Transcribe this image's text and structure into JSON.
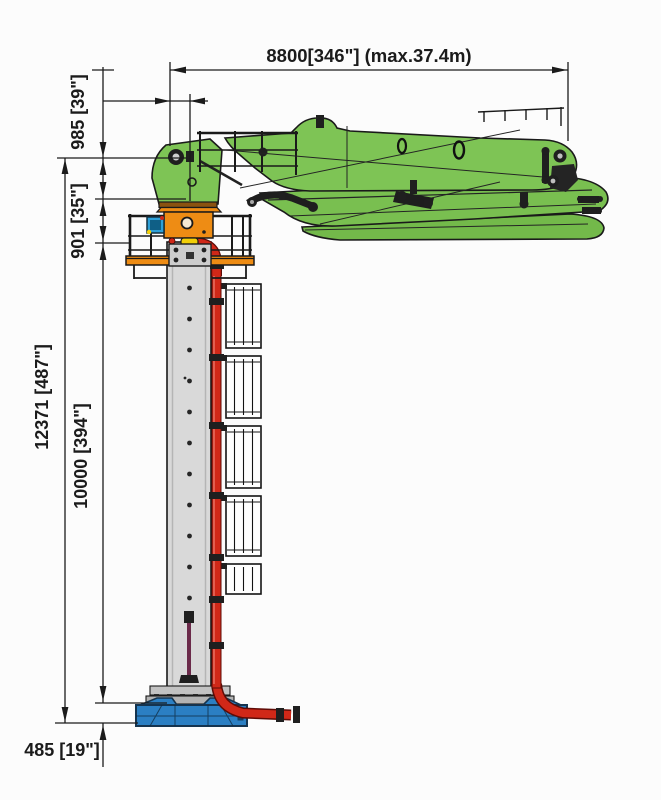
{
  "labels": {
    "reach": "8800[346\"] (max.37.4m)",
    "boom_height": "985 [39\"]",
    "turret_height": "901 [35\"]",
    "overall_height": "12371 [487\"]",
    "mast_height": "10000 [394\"]",
    "base_height": "485 [19\"]"
  },
  "colors": {
    "green": "#7ec455",
    "green2": "#79bf50",
    "green3": "#73b94a",
    "orange": "#ee8c14",
    "orangedark": "#8a5210",
    "blue": "#2b7fc3",
    "motor": "#2ea0d8",
    "red": "#d02818",
    "reddark": "#5e0b06",
    "gray": "#d9d9d9",
    "gray2": "#c2c2c2",
    "yellow": "#f2cf08",
    "ink": "#1b1b1b"
  }
}
